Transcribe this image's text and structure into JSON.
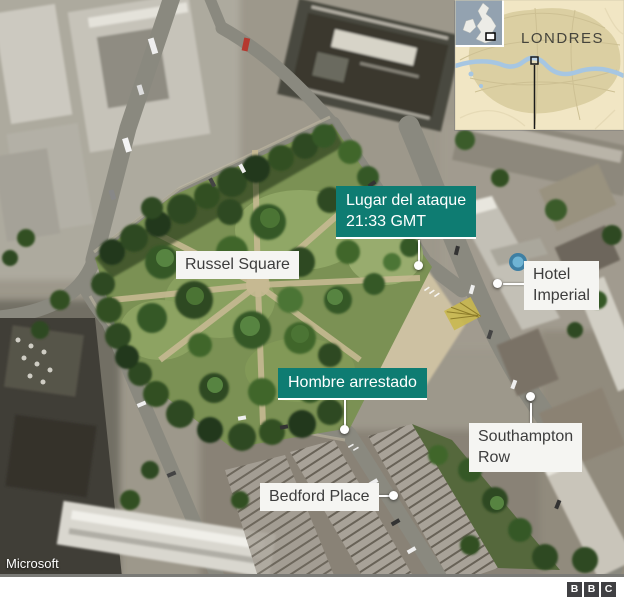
{
  "inset": {
    "city_label": "LONDRES"
  },
  "callouts": {
    "attack": {
      "line1": "Lugar del ataque",
      "line2": "21:33 GMT"
    },
    "park": {
      "label": "Russel Square"
    },
    "hotel": {
      "line1": "Hotel",
      "line2": "Imperial"
    },
    "arrest": {
      "label": "Hombre arrestado"
    },
    "southampton": {
      "line1": "Southampton",
      "line2": "Row"
    },
    "bedford": {
      "label": "Bedford Place"
    }
  },
  "attribution": {
    "map_provider": "Microsoft"
  },
  "footer": {
    "logo_letters": [
      "B",
      "B",
      "C"
    ]
  },
  "colors": {
    "highlight_teal": "#0e7c72",
    "label_bg": "#f5f5f2",
    "label_text": "#3d3d3d",
    "inset_land": "#f1e6c4",
    "inset_urban": "#dbcfa2",
    "inset_river": "#a6c6e2"
  }
}
